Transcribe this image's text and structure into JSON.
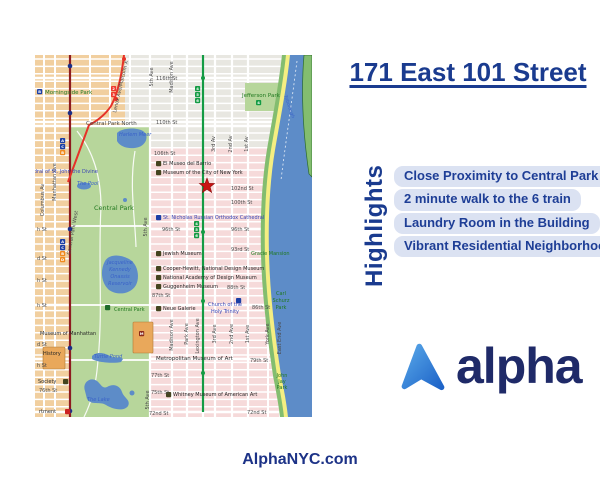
{
  "title": {
    "text": "171 East 101 Street"
  },
  "highlights": {
    "heading": "Highlights",
    "items": [
      "Close Proximity to Central Park",
      "2 minute walk to the 6 train",
      "Laundry Room in the Building",
      "Vibrant Residential Neighborhood"
    ]
  },
  "logo": {
    "wordmark": "alpha",
    "icon": "alpha-mountain-icon"
  },
  "footer": {
    "website": "AlphaNYC.com"
  },
  "colors": {
    "navy": "#1a3b8f",
    "pill_bg": "#dbe2f2",
    "pill_text": "#1e3e96",
    "logo_navy": "#1f2a68",
    "logo_icon_light": "#58a7e8",
    "logo_icon_dark": "#1d63c8"
  },
  "map": {
    "marker": {
      "name": "property-location-star",
      "x": 172,
      "y": 131
    },
    "colors": {
      "blockTan": "#f1cf9f",
      "blockGray": "#e8e7e1",
      "blockPink": "#f6dada",
      "parkGreen": "#b7d69b",
      "water": "#5d8cc8",
      "fdr": "#f4ee82",
      "shoreGreen": "#83bd6f",
      "cpw": "#8e1b1f",
      "red": "#e63228",
      "green": "#149b44",
      "navyDot": "#1b2f86",
      "star": "#c91414",
      "bldg": "#e9a85b"
    },
    "labelColors": {
      "st": "#4a4a4a",
      "pk": "#20781f",
      "wt": "#3a62c8",
      "poi": "#272727",
      "cat": "#3844b4"
    },
    "stations": {
      "navy": [
        [
          35,
          11
        ],
        [
          35,
          58
        ],
        [
          35,
          174
        ],
        [
          35,
          293
        ],
        [
          35,
          356
        ]
      ],
      "red": [
        [
          89,
          4
        ],
        [
          81,
          44
        ]
      ],
      "green": [
        [
          168,
          23
        ],
        [
          168,
          177
        ],
        [
          168,
          246
        ],
        [
          168,
          318
        ]
      ]
    },
    "badges": [
      {
        "t": "4",
        "x": 160,
        "y": 31,
        "bg": "#149b44"
      },
      {
        "t": "5",
        "x": 160,
        "y": 37,
        "bg": "#149b44"
      },
      {
        "t": "6",
        "x": 160,
        "y": 43,
        "bg": "#149b44"
      },
      {
        "t": "4",
        "x": 159,
        "y": 166,
        "bg": "#149b44"
      },
      {
        "t": "5",
        "x": 159,
        "y": 172,
        "bg": "#149b44"
      },
      {
        "t": "6",
        "x": 159,
        "y": 178,
        "bg": "#149b44"
      },
      {
        "t": "4",
        "x": 221,
        "y": 45,
        "bg": "#149b44"
      },
      {
        "t": "2",
        "x": 76,
        "y": 31,
        "bg": "#ee3a2e"
      },
      {
        "t": "3",
        "x": 76,
        "y": 37,
        "bg": "#ee3a2e"
      },
      {
        "t": "B",
        "x": 2,
        "y": 34,
        "bg": "#1b3fa6"
      },
      {
        "t": "A",
        "x": 25,
        "y": 83,
        "bg": "#1b3fa6"
      },
      {
        "t": "C",
        "x": 25,
        "y": 89,
        "bg": "#1b3fa6"
      },
      {
        "t": "B",
        "x": 25,
        "y": 95,
        "bg": "#f08a1e"
      },
      {
        "t": "A",
        "x": 25,
        "y": 184,
        "bg": "#1b3fa6"
      },
      {
        "t": "C",
        "x": 25,
        "y": 190,
        "bg": "#1b3fa6"
      },
      {
        "t": "B",
        "x": 25,
        "y": 196,
        "bg": "#f08a1e"
      },
      {
        "t": "D",
        "x": 25,
        "y": 202,
        "bg": "#f08a1e"
      },
      {
        "t": "",
        "x": 121,
        "y": 106
      },
      {
        "t": "",
        "x": 121,
        "y": 115
      },
      {
        "t": "",
        "x": 121,
        "y": 160,
        "bg": "#1b3fa6"
      },
      {
        "t": "",
        "x": 121,
        "y": 196
      },
      {
        "t": "",
        "x": 121,
        "y": 211
      },
      {
        "t": "",
        "x": 121,
        "y": 220
      },
      {
        "t": "",
        "x": 121,
        "y": 229
      },
      {
        "t": "",
        "x": 121,
        "y": 251
      },
      {
        "t": "",
        "x": 131,
        "y": 337
      },
      {
        "t": "",
        "x": 28,
        "y": 324
      },
      {
        "t": "M",
        "x": 104,
        "y": 276,
        "bg": "#8a2a1a"
      },
      {
        "t": "",
        "x": 201,
        "y": 243,
        "bg": "#1b3fa6"
      },
      {
        "t": "",
        "x": 30,
        "y": 354,
        "bg": "#cc2222"
      },
      {
        "t": "",
        "x": 70,
        "y": 250,
        "bg": "#1d6b2a"
      }
    ],
    "labels": [
      {
        "t": "116th St",
        "x": 121,
        "y": 25
      },
      {
        "t": "110th St",
        "x": 121,
        "y": 69
      },
      {
        "t": "106th St",
        "x": 119,
        "y": 100
      },
      {
        "t": "102nd St",
        "x": 196,
        "y": 135
      },
      {
        "t": "100th St",
        "x": 196,
        "y": 149
      },
      {
        "t": "96th St",
        "x": 127,
        "y": 176
      },
      {
        "t": "96th St",
        "x": 196,
        "y": 176
      },
      {
        "t": "93rd St",
        "x": 196,
        "y": 196
      },
      {
        "t": "88th St",
        "x": 192,
        "y": 234
      },
      {
        "t": "87th St",
        "x": 117,
        "y": 242
      },
      {
        "t": "86th St",
        "x": 217,
        "y": 254
      },
      {
        "t": "79th St",
        "x": 215,
        "y": 307
      },
      {
        "t": "77th St",
        "x": 116,
        "y": 322
      },
      {
        "t": "75th St",
        "x": 116,
        "y": 339
      },
      {
        "t": "72nd St",
        "x": 114,
        "y": 360
      },
      {
        "t": "72nd St",
        "x": 212,
        "y": 359
      },
      {
        "t": "76th St",
        "x": 4,
        "y": 337
      },
      {
        "t": "h St",
        "x": 2,
        "y": 176
      },
      {
        "t": "d St",
        "x": 2,
        "y": 205
      },
      {
        "t": "h St",
        "x": 2,
        "y": 227
      },
      {
        "t": "h St",
        "x": 2,
        "y": 252
      },
      {
        "t": "d St",
        "x": 2,
        "y": 291
      },
      {
        "t": "h St",
        "x": 2,
        "y": 312
      },
      {
        "t": "Central Park North",
        "x": 51,
        "y": 70,
        "s": 5.5
      },
      {
        "t": "5th Ave",
        "x": 118,
        "y": 22,
        "r": -90,
        "a": 1
      },
      {
        "t": "Madison Ave",
        "x": 138,
        "y": 22,
        "r": -90,
        "a": 1
      },
      {
        "t": "3rd Av",
        "x": 180,
        "y": 89,
        "r": -90,
        "a": 1
      },
      {
        "t": "2nd Av",
        "x": 197,
        "y": 89,
        "r": -90,
        "a": 1
      },
      {
        "t": "1st Av",
        "x": 213,
        "y": 89,
        "r": -90,
        "a": 1
      },
      {
        "t": "5th Ave",
        "x": 112,
        "y": 172,
        "r": -90,
        "a": 1
      },
      {
        "t": "Madison Ave",
        "x": 138,
        "y": 280,
        "r": -90,
        "a": 1
      },
      {
        "t": "Park Ave",
        "x": 153,
        "y": 279,
        "r": -90,
        "a": 1
      },
      {
        "t": "Lexington Ave",
        "x": 164,
        "y": 281,
        "r": -90,
        "a": 1
      },
      {
        "t": "3rd Ave",
        "x": 181,
        "y": 279,
        "r": -90,
        "a": 1
      },
      {
        "t": "2nd Ave",
        "x": 198,
        "y": 279,
        "r": -90,
        "a": 1
      },
      {
        "t": "1st Ave",
        "x": 214,
        "y": 279,
        "r": -90,
        "a": 1
      },
      {
        "t": "York Ave",
        "x": 234,
        "y": 279,
        "r": -90,
        "a": 1
      },
      {
        "t": "East End Ave",
        "x": 246,
        "y": 283,
        "r": -90,
        "a": 1
      },
      {
        "t": "5th Ave",
        "x": 114,
        "y": 345,
        "r": -90,
        "a": 1
      },
      {
        "t": "Columbus Av",
        "x": 9,
        "y": 145,
        "r": -90,
        "a": 1
      },
      {
        "t": "Manhattan Ave",
        "x": 21,
        "y": 127,
        "r": -90,
        "a": 1
      },
      {
        "t": "Central Park West",
        "x": 39,
        "y": 178,
        "r": -80,
        "a": 1
      },
      {
        "t": "Lenox Ave/Malcolm X",
        "x": 87,
        "y": 32,
        "r": -77,
        "a": 1
      },
      {
        "t": "Morningside Park",
        "x": 10,
        "y": 39,
        "c": "pk",
        "s": 5.5
      },
      {
        "t": "Jefferson Park",
        "x": 207,
        "y": 42,
        "c": "pk",
        "s": 5.5
      },
      {
        "t": "Central Park",
        "x": 59,
        "y": 155,
        "c": "pk",
        "s": 6.5
      },
      {
        "t": "Central Park",
        "x": 79,
        "y": 256,
        "c": "pk"
      },
      {
        "t": "Gracie Mansion",
        "x": 216,
        "y": 200,
        "c": "pk"
      },
      {
        "t": "Carl",
        "x": 246,
        "y": 240,
        "c": "pk",
        "a": 1
      },
      {
        "t": "Schurz",
        "x": 246,
        "y": 247,
        "c": "pk",
        "a": 1
      },
      {
        "t": "Park",
        "x": 246,
        "y": 254,
        "c": "pk",
        "a": 1
      },
      {
        "t": "John",
        "x": 247,
        "y": 322,
        "c": "pk",
        "a": 1
      },
      {
        "t": "Jay",
        "x": 247,
        "y": 328,
        "c": "pk",
        "a": 1
      },
      {
        "t": "Park",
        "x": 247,
        "y": 334,
        "c": "pk",
        "a": 1
      },
      {
        "t": "Harlem Meer",
        "x": 84,
        "y": 81,
        "c": "wt"
      },
      {
        "t": "The Pool",
        "x": 42,
        "y": 130,
        "c": "wt"
      },
      {
        "t": "Jacqueline",
        "x": 85,
        "y": 209,
        "c": "wt",
        "a": 1
      },
      {
        "t": "Kennedy",
        "x": 85,
        "y": 216,
        "c": "wt",
        "a": 1
      },
      {
        "t": "Onassis",
        "x": 85,
        "y": 223,
        "c": "wt",
        "a": 1
      },
      {
        "t": "Reservoir",
        "x": 85,
        "y": 230,
        "c": "wt",
        "a": 1
      },
      {
        "t": "Turtle Pond",
        "x": 59,
        "y": 303,
        "c": "wt"
      },
      {
        "t": "The Lake",
        "x": 52,
        "y": 346,
        "c": "wt"
      },
      {
        "t": "Triborough",
        "x": 253,
        "y": 52,
        "c": "wt",
        "r": 70,
        "a": 1,
        "s": 4.5
      },
      {
        "t": "El Museo del Barrio",
        "x": 128,
        "y": 110,
        "c": "poi"
      },
      {
        "t": "Museum of the City of New York",
        "x": 128,
        "y": 119,
        "c": "poi"
      },
      {
        "t": "St. Nicholas Russian Orthodox Cathedral",
        "x": 128,
        "y": 164,
        "c": "cat"
      },
      {
        "t": "Jewish Museum",
        "x": 128,
        "y": 200,
        "c": "poi"
      },
      {
        "t": "Cooper-Hewitt, National Design Museum",
        "x": 128,
        "y": 215,
        "c": "poi"
      },
      {
        "t": "National Academy of Design Museum",
        "x": 128,
        "y": 224,
        "c": "poi"
      },
      {
        "t": "Guggenheim Museum",
        "x": 128,
        "y": 233,
        "c": "poi"
      },
      {
        "t": "Neue Galerie",
        "x": 128,
        "y": 255,
        "c": "poi"
      },
      {
        "t": "Church of the",
        "x": 190,
        "y": 251,
        "c": "cat",
        "a": 1
      },
      {
        "t": "Holy Trinity",
        "x": 190,
        "y": 258,
        "c": "cat",
        "a": 1
      },
      {
        "t": "Metropolitan Museum of Art",
        "x": 121,
        "y": 305,
        "c": "poi",
        "s": 5.5
      },
      {
        "t": "Whitney Museum of American Art",
        "x": 138,
        "y": 341,
        "c": "poi"
      },
      {
        "t": "Cathedral of St. John the Divine",
        "x": -16,
        "y": 118,
        "c": "cat"
      },
      {
        "t": "Museum of Manhattan",
        "x": 5,
        "y": 280,
        "c": "poi"
      },
      {
        "t": "History",
        "x": 8,
        "y": 300,
        "c": "poi"
      },
      {
        "t": "Society",
        "x": 3,
        "y": 328,
        "c": "poi"
      },
      {
        "t": "rtment",
        "x": 4,
        "y": 358,
        "c": "poi"
      }
    ]
  }
}
